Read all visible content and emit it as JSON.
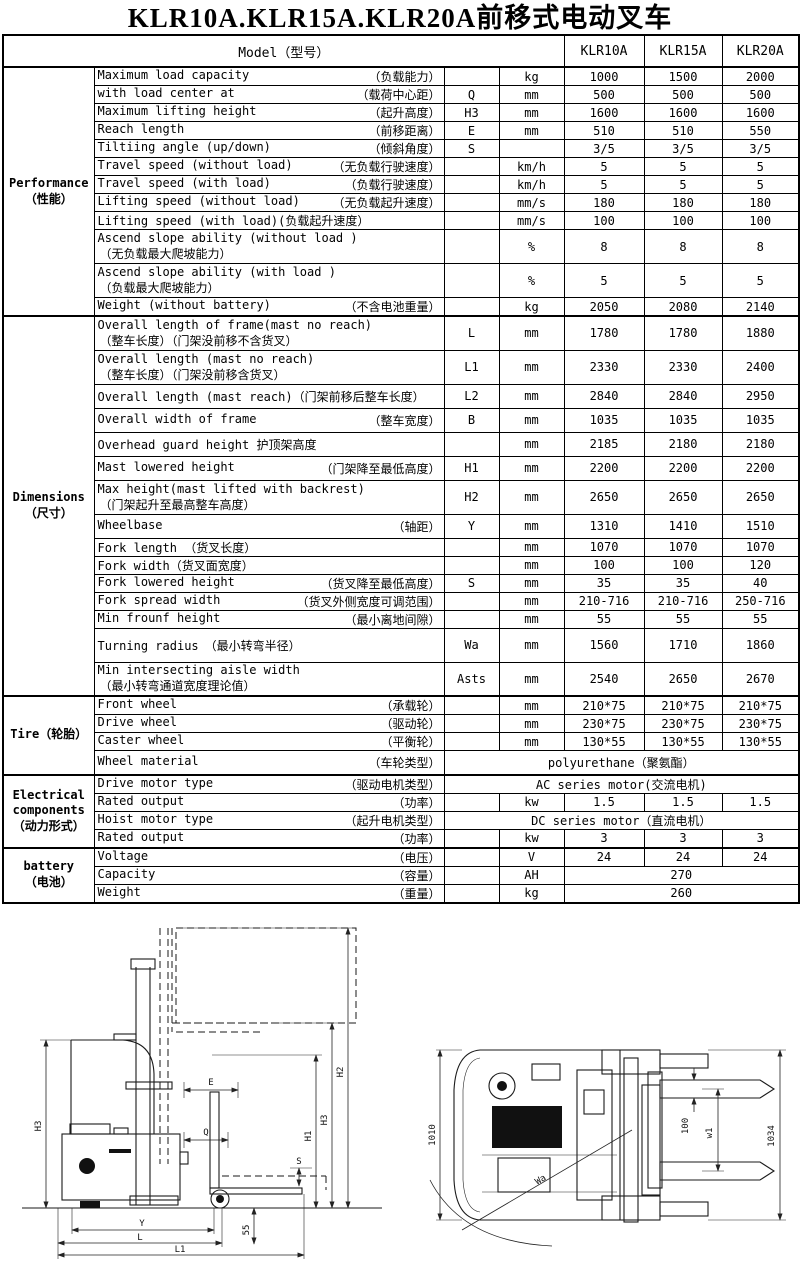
{
  "title": "KLR10A.KLR15A.KLR20A前移式电动叉车",
  "table": {
    "model_label": "Model（型号）",
    "models": [
      "KLR10A",
      "KLR15A",
      "KLR20A"
    ],
    "sections": [
      {
        "name_lines": [
          "Performance",
          "（性能）"
        ],
        "rows": [
          {
            "en": "Maximum load capacity",
            "cn": "（负载能力）",
            "sym": "",
            "unit": "kg",
            "vals": [
              "1000",
              "1500",
              "2000"
            ],
            "size": "s"
          },
          {
            "en": "with load center at",
            "cn": "（载荷中心距）",
            "sym": "Q",
            "unit": "mm",
            "vals": [
              "500",
              "500",
              "500"
            ],
            "size": "s"
          },
          {
            "en": "Maximum lifting height",
            "cn": "（起升高度）",
            "sym": "H3",
            "unit": "mm",
            "vals": [
              "1600",
              "1600",
              "1600"
            ],
            "size": "s"
          },
          {
            "en": "Reach length",
            "cn": "（前移距离）",
            "sym": "E",
            "unit": "mm",
            "vals": [
              "510",
              "510",
              "550"
            ],
            "size": "s"
          },
          {
            "en": "Tiltiing angle (up/down)",
            "cn": "（倾斜角度）",
            "sym": "S",
            "unit": "",
            "vals": [
              "3/5",
              "3/5",
              "3/5"
            ],
            "size": "s"
          },
          {
            "en": "Travel speed (without load)",
            "cn": "（无负载行驶速度）",
            "sym": "",
            "unit": "km/h",
            "vals": [
              "5",
              "5",
              "5"
            ],
            "size": "s"
          },
          {
            "en": "Travel speed (with load)",
            "cn": "（负载行驶速度）",
            "sym": "",
            "unit": "km/h",
            "vals": [
              "5",
              "5",
              "5"
            ],
            "size": "s"
          },
          {
            "en": "Lifting speed (without load)",
            "cn": "（无负载起升速度）",
            "sym": "",
            "unit": "mm/s",
            "vals": [
              "180",
              "180",
              "180"
            ],
            "size": "s"
          },
          {
            "en": "Lifting speed (with load)(负载起升速度）",
            "cn": "",
            "sym": "",
            "unit": "mm/s",
            "vals": [
              "100",
              "100",
              "100"
            ],
            "size": "s"
          },
          {
            "en": "Ascend slope ability (without load )",
            "cn2": "（无负载最大爬坡能力）",
            "sym": "",
            "unit": "%",
            "vals": [
              "8",
              "8",
              "8"
            ],
            "size": "l"
          },
          {
            "en": "Ascend slope ability (with load )",
            "cn2": "（负载最大爬坡能力）",
            "sym": "",
            "unit": "%",
            "vals": [
              "5",
              "5",
              "5"
            ],
            "size": "l"
          },
          {
            "en": "Weight (without battery)",
            "cn": "（不含电池重量）",
            "sym": "",
            "unit": "kg",
            "vals": [
              "2050",
              "2080",
              "2140"
            ],
            "size": "s"
          }
        ]
      },
      {
        "name_lines": [
          "Dimensions",
          "（尺寸）"
        ],
        "rows": [
          {
            "en": "Overall length of frame(mast no reach)",
            "cn2": "（整车长度）（门架没前移不含货叉）",
            "sym": "L",
            "unit": "mm",
            "vals": [
              "1780",
              "1780",
              "1880"
            ],
            "size": "l"
          },
          {
            "en": "Overall length (mast no reach)",
            "cn2": "（整车长度）（门架没前移含货叉）",
            "sym": "L1",
            "unit": "mm",
            "vals": [
              "2330",
              "2330",
              "2400"
            ],
            "size": "l"
          },
          {
            "en": "Overall length (mast reach)（门架前移后整车长度）",
            "cn": "",
            "sym": "L2",
            "unit": "mm",
            "vals": [
              "2840",
              "2840",
              "2950"
            ],
            "size": "m"
          },
          {
            "en": "Overall width of frame",
            "cn": "（整车宽度）",
            "sym": "B",
            "unit": "mm",
            "vals": [
              "1035",
              "1035",
              "1035"
            ],
            "size": "m"
          },
          {
            "en": "Overhead guard height 护顶架高度",
            "cn": "",
            "sym": "",
            "unit": "mm",
            "vals": [
              "2185",
              "2180",
              "2180"
            ],
            "size": "m"
          },
          {
            "en": "Mast lowered height",
            "cn": "（门架降至最低高度）",
            "sym": "H1",
            "unit": "mm",
            "vals": [
              "2200",
              "2200",
              "2200"
            ],
            "size": "m"
          },
          {
            "en": "Max height(mast lifted with backrest)",
            "cn2": "（门架起升至最高整车高度）",
            "sym": "H2",
            "unit": "mm",
            "vals": [
              "2650",
              "2650",
              "2650"
            ],
            "size": "l"
          },
          {
            "en": "Wheelbase",
            "cn": "（轴距）",
            "sym": "Y",
            "unit": "mm",
            "vals": [
              "1310",
              "1410",
              "1510"
            ],
            "size": "m"
          },
          {
            "en": "Fork length （货叉长度）",
            "cn": "",
            "sym": "",
            "unit": "mm",
            "vals": [
              "1070",
              "1070",
              "1070"
            ],
            "size": "s"
          },
          {
            "en": "Fork width（货叉面宽度）",
            "cn": "",
            "sym": "",
            "unit": "mm",
            "vals": [
              "100",
              "100",
              "120"
            ],
            "size": "s"
          },
          {
            "en": "Fork lowered height",
            "cn": "（货叉降至最低高度）",
            "sym": "S",
            "unit": "mm",
            "vals": [
              "35",
              "35",
              "40"
            ],
            "size": "s"
          },
          {
            "en": "Fork spread width",
            "cn": "（货叉外侧宽度可调范围）",
            "sym": "",
            "unit": "mm",
            "vals": [
              "210-716",
              "210-716",
              "250-716"
            ],
            "size": "s"
          },
          {
            "en": "Min frounf height",
            "cn": "（最小离地间隙）",
            "sym": "",
            "unit": "mm",
            "vals": [
              "55",
              "55",
              "55"
            ],
            "size": "s"
          },
          {
            "en": "Turning radius　（最小转弯半径）",
            "cn": "",
            "sym": "Wa",
            "unit": "mm",
            "vals": [
              "1560",
              "1710",
              "1860"
            ],
            "size": "l"
          },
          {
            "en": "Min intersecting aisle width",
            "cn2": "（最小转弯通道宽度理论值）",
            "sym": "Asts",
            "unit": "mm",
            "vals": [
              "2540",
              "2650",
              "2670"
            ],
            "size": "l"
          }
        ]
      },
      {
        "name_lines": [
          "Tire（轮胎）"
        ],
        "rows": [
          {
            "en": "Front wheel",
            "cn": "（承载轮）",
            "sym": "",
            "unit": "mm",
            "vals": [
              "210*75",
              "210*75",
              "210*75"
            ],
            "size": "s"
          },
          {
            "en": "Drive wheel",
            "cn": "（驱动轮）",
            "sym": "",
            "unit": "mm",
            "vals": [
              "230*75",
              "230*75",
              "230*75"
            ],
            "size": "s"
          },
          {
            "en": "Caster wheel",
            "cn": "（平衡轮）",
            "sym": "",
            "unit": "mm",
            "vals": [
              "130*55",
              "130*55",
              "130*55"
            ],
            "size": "s"
          },
          {
            "en": "Wheel material",
            "cn": "（车轮类型）",
            "merged_all": "polyurethane（聚氨酯）",
            "size": "m"
          }
        ]
      },
      {
        "name_lines": [
          "Electrical",
          "components",
          "（动力形式）"
        ],
        "rows": [
          {
            "en": "Drive motor type",
            "cn": "（驱动电机类型）",
            "merged_all": "AC series motor(交流电机)",
            "size": "s"
          },
          {
            "en": "Rated output",
            "cn": "（功率）",
            "sym": "",
            "unit": "kw",
            "vals": [
              "1.5",
              "1.5",
              "1.5"
            ],
            "size": "s"
          },
          {
            "en": "Hoist motor type",
            "cn": "（起升电机类型）",
            "merged_all": "DC series motor（直流电机）",
            "size": "s"
          },
          {
            "en": "Rated output",
            "cn": "（功率）",
            "sym": "",
            "unit": "kw",
            "vals": [
              "3",
              "3",
              "3"
            ],
            "size": "s"
          }
        ]
      },
      {
        "name_lines": [
          "battery",
          "（电池）"
        ],
        "rows": [
          {
            "en": "Voltage",
            "cn": "（电压）",
            "sym": "",
            "unit": "V",
            "vals": [
              "24",
              "24",
              "24"
            ],
            "size": "s"
          },
          {
            "en": "Capacity",
            "cn": "（容量）",
            "sym": "",
            "unit": "AH",
            "merged3": "270",
            "size": "s"
          },
          {
            "en": "Weight",
            "cn": "（重量）",
            "sym": "",
            "unit": "kg",
            "merged3": "260",
            "size": "s"
          }
        ]
      }
    ]
  },
  "drawings": {
    "side_view": {
      "h3_left": "H3",
      "e": "E",
      "q": "Q",
      "s": "S",
      "gc": "55",
      "y": "Y",
      "l": "L",
      "l1": "L1",
      "h1": "H1",
      "h3_right": "H3",
      "h2": "H2"
    },
    "top_view": {
      "body_width": "1010",
      "fork_width": "100",
      "fork_spread": "w1",
      "overall_width": "1034",
      "turning_radius": "Wa"
    }
  }
}
